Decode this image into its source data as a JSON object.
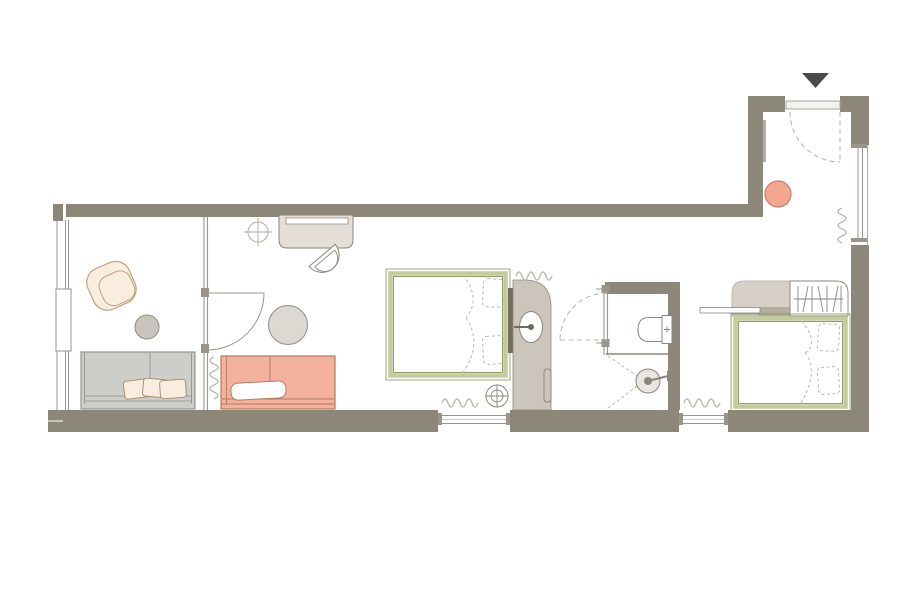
{
  "colors": {
    "floor": "#ffffff",
    "wall": "#8d8779",
    "wall_accent": "#b3ada1",
    "outline": "#8b857a",
    "line_light": "#bdb8ae",
    "glass": "#9a948c",
    "bed_frame": "#c3cc9b",
    "bed_frame_dark": "#83925a",
    "salmon": "#f4b29e",
    "salmon_outline": "#ad7b61",
    "stool_pink": "#f4a68f",
    "stool_outline": "#c57f67",
    "desk_beige": "#e4ded6",
    "wardrobe_beige": "#d7d0c6",
    "wardrobe_shadow": "#b5ad9f",
    "vanity_taupe": "#ccc5bb",
    "headboard_dark": "#756f60",
    "sofa_gray": "#cdcdca",
    "sofa_gray_outline": "#908c83",
    "table_gray": "#c9c5bd",
    "table_beige": "#ddd8d1",
    "cream": "#f8edde",
    "cream_outline": "#c2a17c",
    "pillow_outline": "#a58a67",
    "marker_dark": "#4b4b4b",
    "shower_fill": "#e9e6e1"
  },
  "symbols": {
    "entrance_marker": "filled-triangle-down",
    "ceiling_light": "circle-with-cross",
    "floor_spot": "circle-with-crosshair",
    "radiator": "squiggle-line",
    "door_swing": "quarter-arc",
    "sliding_door_swing": "dashed-quarter-arc",
    "shower_head": "concentric-circles-with-arm",
    "clothes_rail": "rail-with-hanger-strokes",
    "bed_linen": "dashed-duvet-curves-and-pillows"
  }
}
